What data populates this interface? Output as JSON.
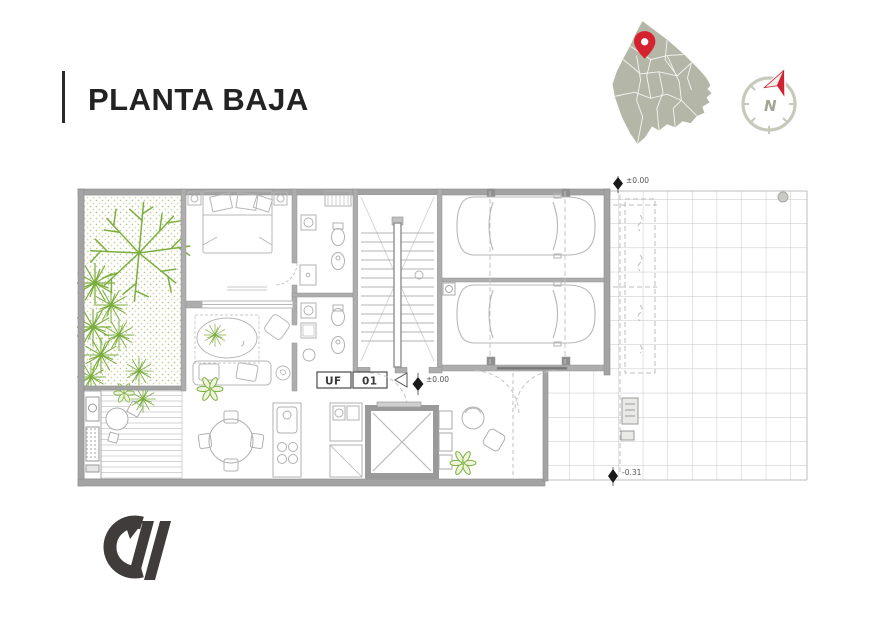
{
  "header": {
    "title": "PLANTA BAJA"
  },
  "locator": {
    "map_icon": "buenos-aires-district-map",
    "pin_icon": "location-pin",
    "compass": {
      "letter": "N"
    }
  },
  "plan": {
    "unit_label": {
      "left": "UF",
      "right": "01"
    },
    "levels": {
      "ground_top": "±0.00",
      "ground_center": "±0.00",
      "street": "-0.31"
    }
  },
  "footer": {
    "logo": "cw-monogram"
  },
  "colors": {
    "ink": "#2b2b2b",
    "accent_red": "#d6222e",
    "map_fill": "#b4b7a7",
    "compass_ring": "#c7c9bb",
    "plant_green": "#7cae3f",
    "wall_gray": "#a3a3a3",
    "line_gray": "#bdbdbd"
  }
}
